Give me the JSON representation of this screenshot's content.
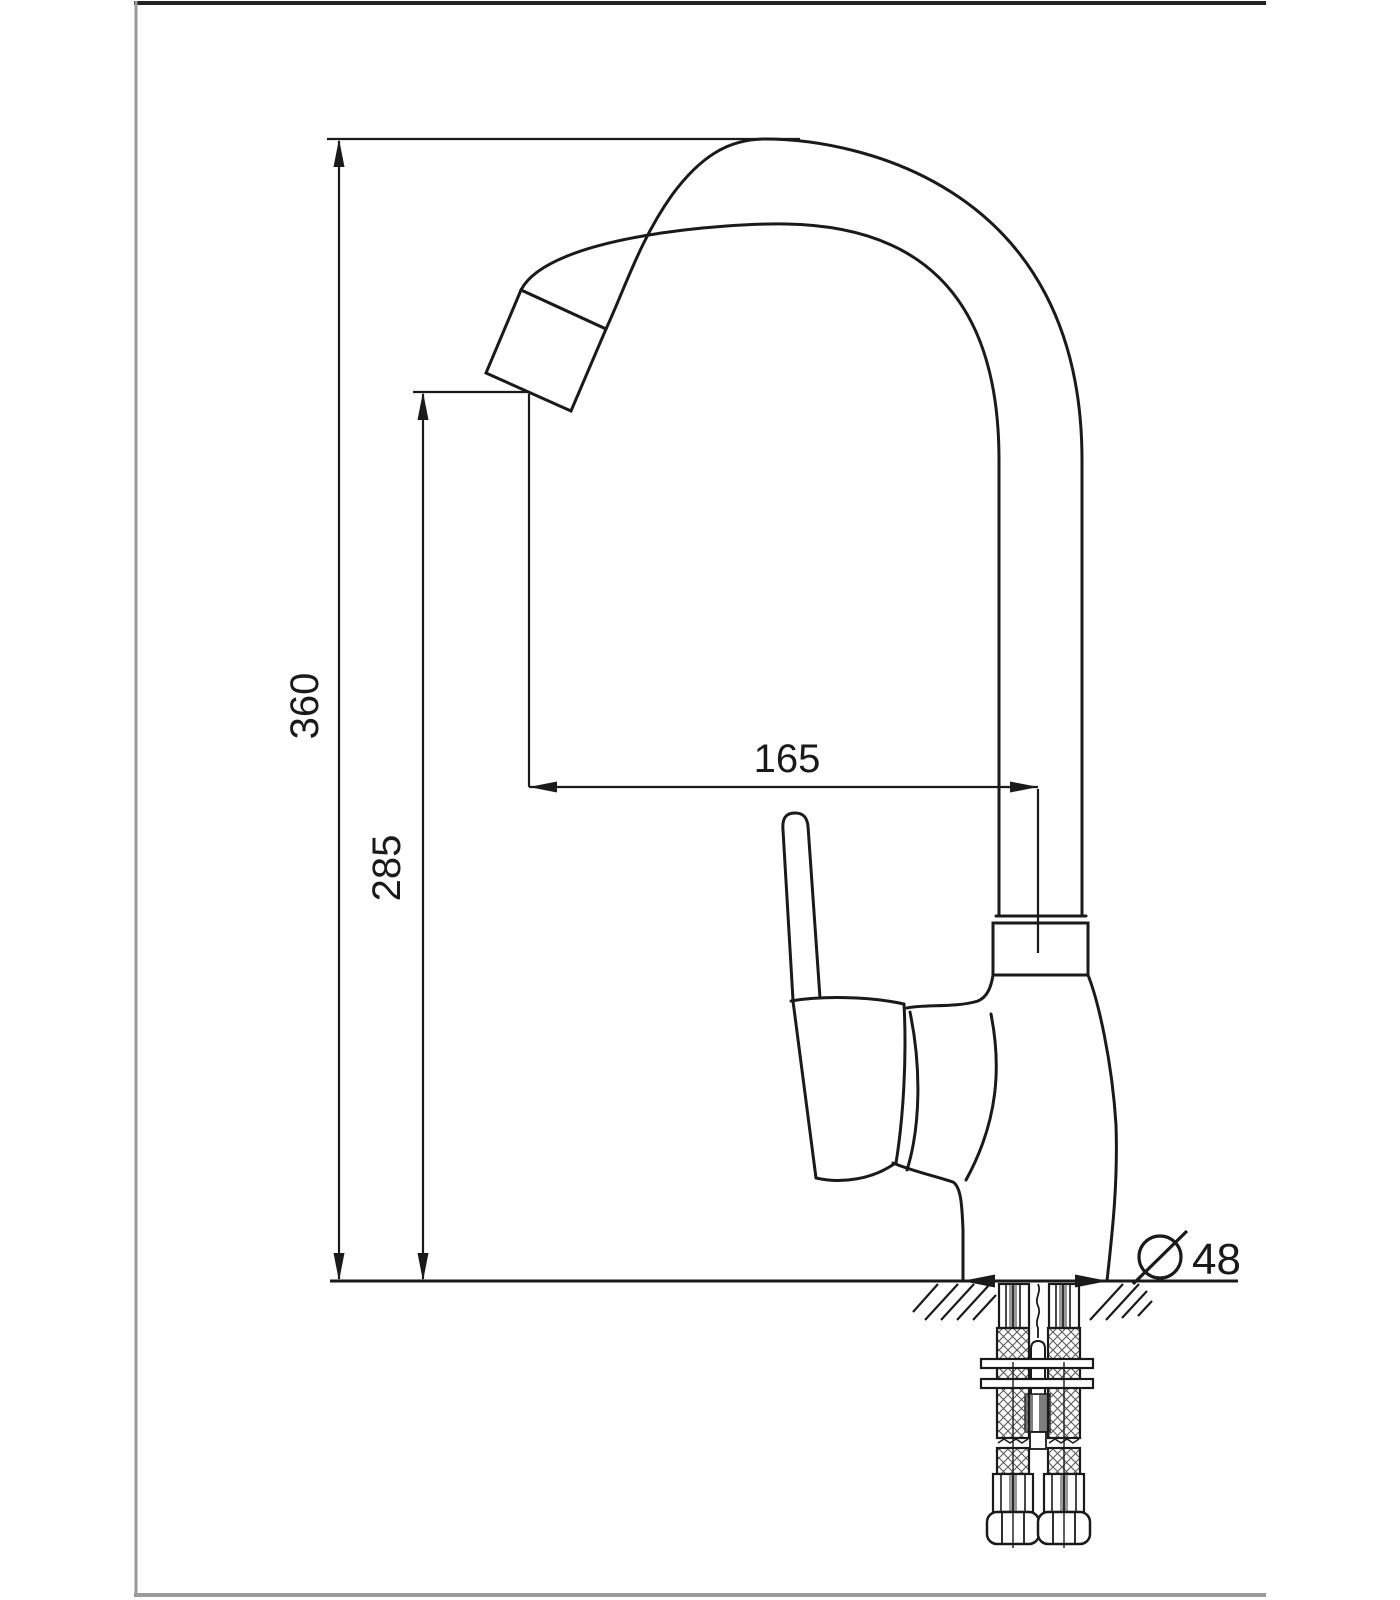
{
  "drawing": {
    "subject": "kitchen-faucet-technical-drawing",
    "view": "side-elevation-with-mounting-detail",
    "colors": {
      "line": "#1a1a1a",
      "frame_top": "#222222",
      "frame_side": "#9a9a9a",
      "background": "#ffffff",
      "hardware_gray": "#7d7d7d",
      "stripe_gray": "#999999"
    },
    "dimensions": {
      "overall_height": {
        "value": "360",
        "orientation": "vertical",
        "units_implied": "mm"
      },
      "spout_height": {
        "value": "285",
        "orientation": "vertical",
        "units_implied": "mm"
      },
      "spout_reach": {
        "value": "165",
        "orientation": "horizontal",
        "units_implied": "mm"
      },
      "base_diameter": {
        "value": "48",
        "symbol": "diameter-circle-slash",
        "units_implied": "mm"
      }
    }
  }
}
